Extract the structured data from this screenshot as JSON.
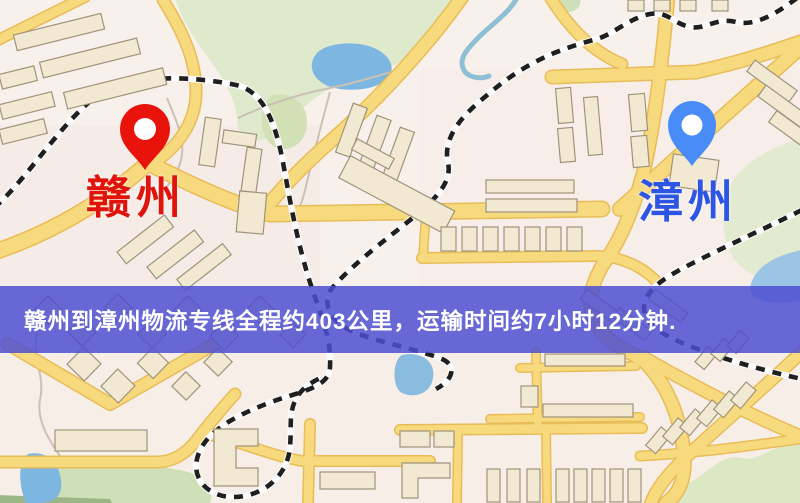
{
  "banner": {
    "text": "赣州到漳州物流专线全程约403公里，运输时间约7小时12分钟."
  },
  "route": {
    "origin_city": "赣州",
    "destination_city": "漳州",
    "distance_km": "403",
    "duration": "7小时12分钟"
  },
  "markers": [
    {
      "id": "origin",
      "city": "赣州",
      "icon": "map-pin-icon"
    },
    {
      "id": "destination",
      "city": "漳州",
      "icon": "map-pin-icon"
    }
  ],
  "colors": {
    "origin_pin": "#e8140c",
    "origin_label": "#e0140c",
    "dest_pin": "#4a8cf7",
    "dest_label": "#2c55e6",
    "banner_bg": "rgba(77,79,209,0.85)",
    "banner_text": "#ffffff",
    "road": "#f7d97e",
    "railway": "#1f1f1f",
    "water": "#7eb6e2",
    "park": "#dfe9cc",
    "building": "#f1e9d2"
  }
}
